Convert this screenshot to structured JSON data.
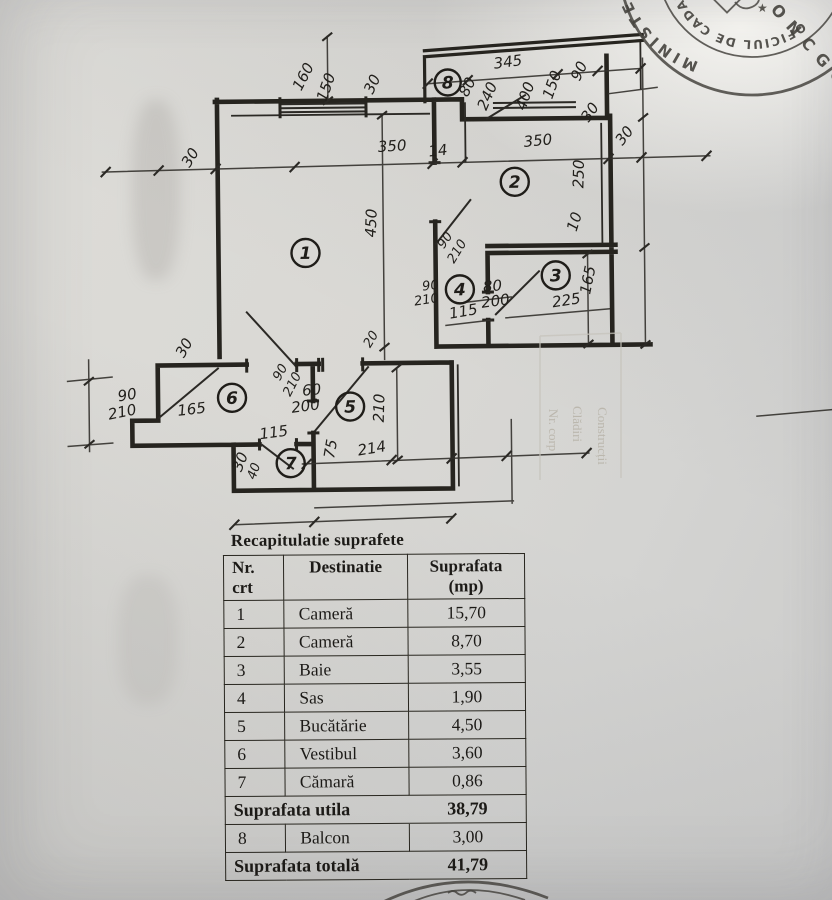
{
  "table": {
    "title": "Recapitulatie suprafete",
    "headers": {
      "nr_line1": "Nr.",
      "nr_line2": "crt",
      "destinatie": "Destinatie",
      "suprafata_line1": "Suprafata",
      "suprafata_line2": "(mp)"
    },
    "rows": [
      {
        "type": "item",
        "nr": "1",
        "name": "Cameră",
        "area": "15,70"
      },
      {
        "type": "item",
        "nr": "2",
        "name": "Cameră",
        "area": "8,70"
      },
      {
        "type": "item",
        "nr": "3",
        "name": "Baie",
        "area": "3,55"
      },
      {
        "type": "item",
        "nr": "4",
        "name": "Sas",
        "area": "1,90"
      },
      {
        "type": "item",
        "nr": "5",
        "name": "Bucătărie",
        "area": "4,50"
      },
      {
        "type": "item",
        "nr": "6",
        "name": "Vestibul",
        "area": "3,60"
      },
      {
        "type": "item",
        "nr": "7",
        "name": "Cămară",
        "area": "0,86"
      },
      {
        "type": "summary",
        "name": "Suprafata utila",
        "area": "38,79"
      },
      {
        "type": "item",
        "nr": "8",
        "name": "Balcon",
        "area": "3,00"
      },
      {
        "type": "summary",
        "name": "Suprafata totală",
        "area": "41,79"
      }
    ]
  },
  "plan": {
    "room_numbers": [
      {
        "n": "1",
        "x": 306,
        "y": 252
      },
      {
        "n": "2",
        "x": 516,
        "y": 183
      },
      {
        "n": "3",
        "x": 556,
        "y": 277
      },
      {
        "n": "4",
        "x": 460,
        "y": 290
      },
      {
        "n": "5",
        "x": 349,
        "y": 406
      },
      {
        "n": "6",
        "x": 231,
        "y": 396
      },
      {
        "n": "7",
        "x": 289,
        "y": 462
      },
      {
        "n": "8",
        "x": 450,
        "y": 83
      }
    ],
    "dim_labels": [
      {
        "t": "160",
        "x": 310,
        "y": 78,
        "r": -62
      },
      {
        "t": "150",
        "x": 333,
        "y": 88,
        "r": -70
      },
      {
        "t": "30",
        "x": 379,
        "y": 86,
        "r": -64
      },
      {
        "t": "30",
        "x": 196,
        "y": 158,
        "r": -58
      },
      {
        "t": "350",
        "x": 394,
        "y": 151,
        "r": -3
      },
      {
        "t": "14",
        "x": 440,
        "y": 156,
        "r": -6
      },
      {
        "t": "350",
        "x": 540,
        "y": 147,
        "r": -5
      },
      {
        "t": "30",
        "x": 630,
        "y": 141,
        "r": -52
      },
      {
        "t": "345",
        "x": 511,
        "y": 68,
        "r": -7
      },
      {
        "t": "80",
        "x": 474,
        "y": 90,
        "r": -62
      },
      {
        "t": "240",
        "x": 494,
        "y": 99,
        "r": -66
      },
      {
        "t": "400",
        "x": 532,
        "y": 99,
        "r": -70
      },
      {
        "t": "150",
        "x": 559,
        "y": 88,
        "r": -70
      },
      {
        "t": "90",
        "x": 586,
        "y": 75,
        "r": -64
      },
      {
        "t": "30",
        "x": 596,
        "y": 117,
        "r": -55
      },
      {
        "t": "250",
        "x": 585,
        "y": 176,
        "r": -88
      },
      {
        "t": "10",
        "x": 580,
        "y": 225,
        "r": -72
      },
      {
        "t": "165",
        "x": 593,
        "y": 283,
        "r": -78
      },
      {
        "t": "450",
        "x": 377,
        "y": 223,
        "r": -87
      },
      {
        "t": "90",
        "x": 431,
        "y": 290,
        "r": -6,
        "s": 1
      },
      {
        "t": "210",
        "x": 427,
        "y": 304,
        "r": -8,
        "s": 1
      },
      {
        "t": "90",
        "x": 449,
        "y": 243,
        "r": -55,
        "s": 1
      },
      {
        "t": "210",
        "x": 461,
        "y": 254,
        "r": -58,
        "s": 1
      },
      {
        "t": "80",
        "x": 493,
        "y": 292,
        "r": -4
      },
      {
        "t": "200",
        "x": 496,
        "y": 307,
        "r": -7
      },
      {
        "t": "115",
        "x": 464,
        "y": 317,
        "r": -9
      },
      {
        "t": "225",
        "x": 567,
        "y": 307,
        "r": -8
      },
      {
        "t": "165",
        "x": 191,
        "y": 412,
        "r": -6
      },
      {
        "t": "90",
        "x": 127,
        "y": 397,
        "r": -9
      },
      {
        "t": "210",
        "x": 122,
        "y": 414,
        "r": -11
      },
      {
        "t": "30",
        "x": 188,
        "y": 348,
        "r": -60
      },
      {
        "t": "90",
        "x": 283,
        "y": 373,
        "r": -60,
        "s": 1
      },
      {
        "t": "210",
        "x": 295,
        "y": 385,
        "r": -62,
        "s": 1
      },
      {
        "t": "60",
        "x": 311,
        "y": 394,
        "r": -4
      },
      {
        "t": "200",
        "x": 305,
        "y": 410,
        "r": -7
      },
      {
        "t": "115",
        "x": 273,
        "y": 436,
        "r": -7
      },
      {
        "t": "30",
        "x": 243,
        "y": 462,
        "r": -68
      },
      {
        "t": "40",
        "x": 256,
        "y": 471,
        "r": -70,
        "s": 1
      },
      {
        "t": "75",
        "x": 334,
        "y": 449,
        "r": -80
      },
      {
        "t": "214",
        "x": 371,
        "y": 453,
        "r": -9
      },
      {
        "t": "210",
        "x": 383,
        "y": 408,
        "r": -88
      },
      {
        "t": "20",
        "x": 374,
        "y": 341,
        "r": -58,
        "s": 1
      }
    ],
    "bleed_labels": [
      {
        "t": "Nr. corp",
        "x": 549,
        "y": 430
      },
      {
        "t": "Clădiri",
        "x": 573,
        "y": 424
      },
      {
        "t": "Construcții",
        "x": 598,
        "y": 436
      }
    ]
  },
  "stamps": {
    "top_right": {
      "ring_text": "MINISTERUL",
      "arc_text": "OFICIUL DE CADASTRU,",
      "center_text": "ONCGC"
    }
  }
}
